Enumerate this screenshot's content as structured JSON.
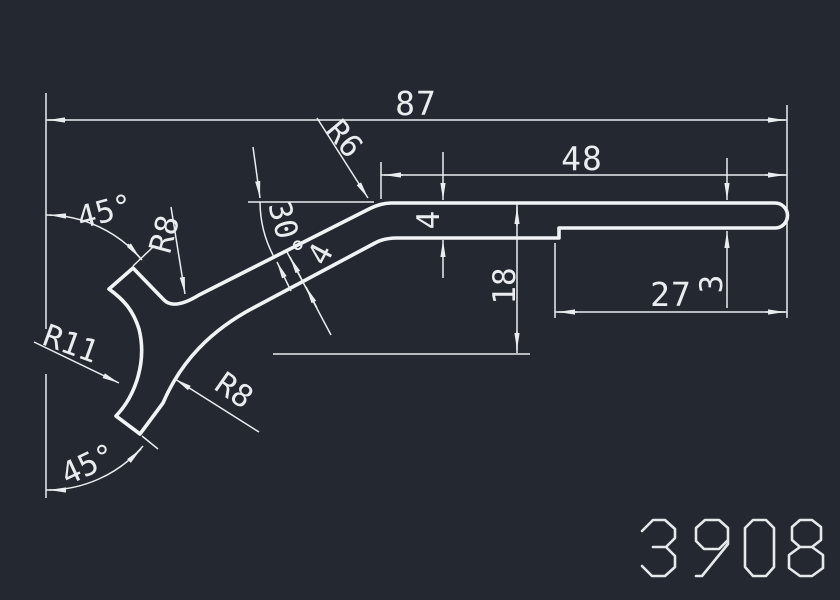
{
  "drawing": {
    "part_number": "3908",
    "colors": {
      "background": "#242830",
      "line": "#f1f4f6",
      "dimension": "#e9edf0"
    },
    "dimensions": {
      "overall_width": "87",
      "top_arm_length": "48",
      "step_length": "27",
      "tip_thickness": "3",
      "arm_thickness": "4",
      "drop_height": "18",
      "diagonal_thickness": "4",
      "diagonal_angle": "30°",
      "upper_prong_angle": "45°",
      "lower_prong_angle": "45°",
      "fillet_top_valley": "R8",
      "fillet_lower": "R8",
      "fillet_junction": "R6",
      "fillet_left_concave": "R11"
    }
  }
}
